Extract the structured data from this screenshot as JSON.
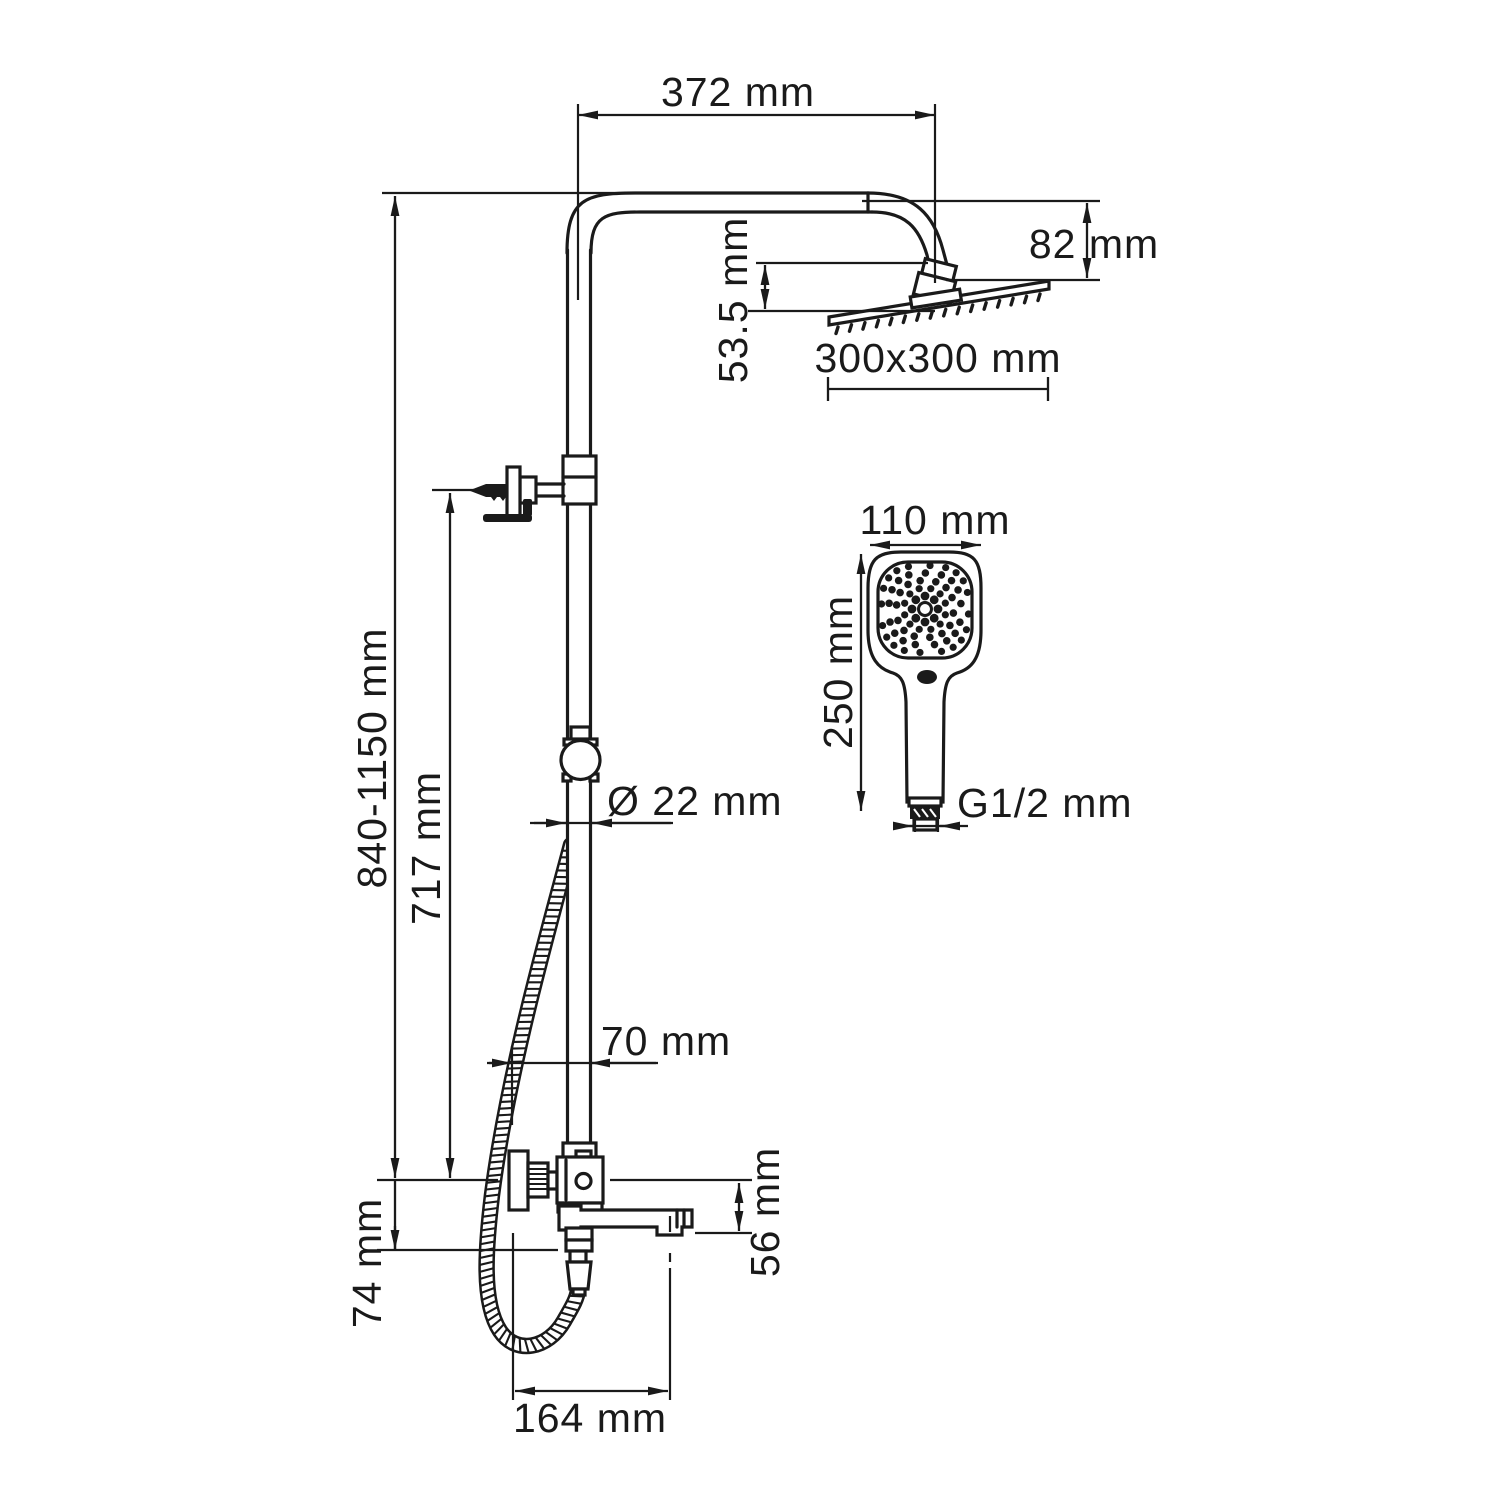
{
  "colors": {
    "ink": "#1a1a1a",
    "background": "#ffffff"
  },
  "drawing_type": "shower-system-dimensional-drawing",
  "dimensions": {
    "arm_reach": "372 mm",
    "head_drop": "82 mm",
    "head_offset": "53.5 mm",
    "head_size": "300x300 mm",
    "handshower_width": "110 mm",
    "handshower_length": "250 mm",
    "thread": "G1/2 mm",
    "column_height": "840-1150 mm",
    "bracket_height": "717 mm",
    "pipe_diameter": "Ø 22 mm",
    "wall_offset": "70 mm",
    "mixer_drop": "74 mm",
    "spout_drop": "56 mm",
    "spout_reach": "164 mm"
  }
}
